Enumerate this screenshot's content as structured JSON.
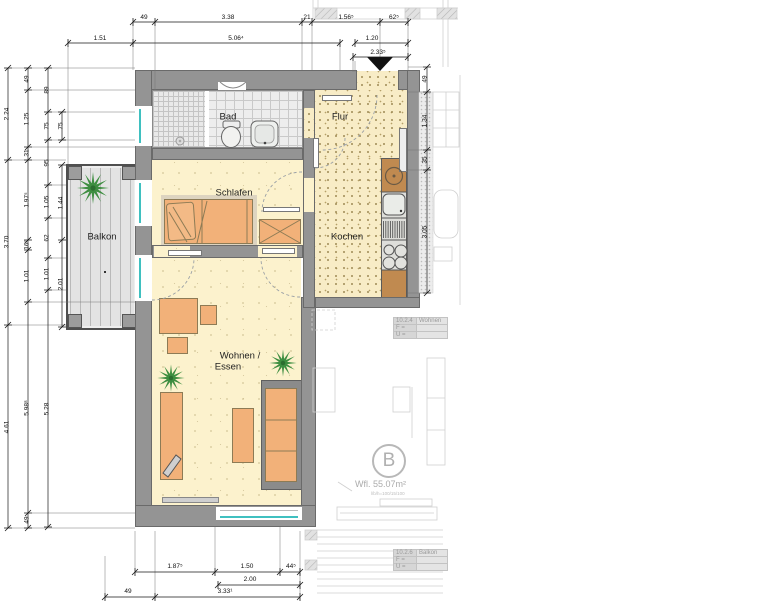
{
  "plan": {
    "rooms": {
      "bad": "Bad",
      "flur": "Flur",
      "schlafen": "Schlafen",
      "kochen": "Kochen",
      "balkon": "Balkon",
      "wohnen_line1": "Wohnen /",
      "wohnen_line2": "Essen"
    },
    "unit": {
      "letter": "B",
      "area": "Wfl. 55.07m²",
      "note": "l/b/h=100/15/100"
    },
    "tables": [
      {
        "code": "10.2.4",
        "name": "Wohnen",
        "row1": "F =",
        "row2": "U ="
      },
      {
        "code": "10.2.6",
        "name": "Balkon",
        "row1": "F =",
        "row2": "U ="
      }
    ],
    "dims": {
      "t1": [
        "49",
        "3.38",
        "21",
        "1.56⁵",
        "62⁵"
      ],
      "t2": [
        "1.51",
        "5.06⁴",
        "1.20"
      ],
      "t3": [
        "2.33⁵"
      ],
      "l1": [
        "2.24",
        "3.70",
        "4.61"
      ],
      "l2": [
        "49",
        "1.25",
        "31",
        "1.97⁵",
        "16⁷",
        "1.01",
        "5.98⁸",
        "49"
      ],
      "l3": [
        "89",
        "75",
        "95",
        "1.05",
        "62",
        "1.01",
        "5.28"
      ],
      "l4": [
        "75",
        "1.44",
        "2.01"
      ],
      "r1": [
        "49",
        "1.34",
        "35",
        "3.05"
      ],
      "b1": [
        "1.87⁵",
        "1.50",
        "44⁵"
      ],
      "b2": [
        "2.00"
      ],
      "b3": [
        "49",
        "3.33¹"
      ]
    },
    "colors": {
      "wall": "#949494",
      "floor_warm": "#f8ecc6",
      "floor_pale": "#fcf2cd",
      "glazing": "#3fc0c0",
      "furniture": "#f2b179",
      "plant": "#3e8e41"
    }
  }
}
